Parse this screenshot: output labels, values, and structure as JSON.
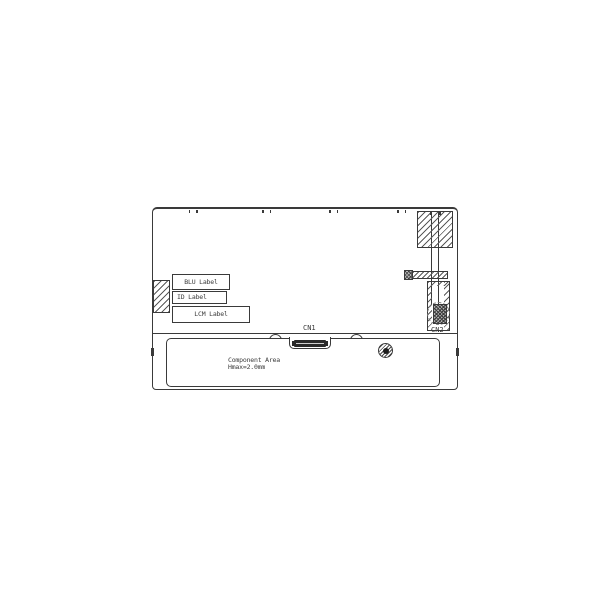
{
  "drawing": {
    "title": "lcd-module-rear-view-drawing",
    "labels": {
      "blu": "BLU Label",
      "id": "ID Label",
      "lcm": "LCM Label"
    },
    "connectors": {
      "cn1": "CN1",
      "cn2": "CN2"
    },
    "component_area": {
      "line1": "Component Area",
      "line2": "Hmax=2.0mm"
    },
    "colors": {
      "line": "#3a3a3a",
      "hatch": "#5a5a5a",
      "background": "#ffffff"
    }
  }
}
